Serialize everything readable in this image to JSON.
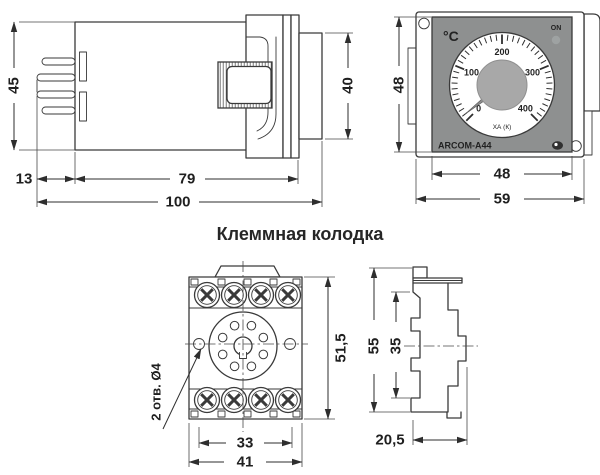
{
  "title": "Клеммная колодка",
  "views": {
    "side": {
      "dims": {
        "height": "45",
        "bezel_height": "40",
        "pin_length": "13",
        "body_length": "79",
        "total_length": "100"
      }
    },
    "front": {
      "dims": {
        "panel_height": "48",
        "panel_width": "48",
        "plate_width": "59"
      },
      "panel": {
        "unit": "°C",
        "on_label": "ON",
        "model": "ARCOM-A44",
        "thermocouple": "ХА (К)"
      },
      "gauge": {
        "type": "gauge",
        "min": 0,
        "max": 400,
        "major_ticks": [
          0,
          100,
          200,
          300,
          400
        ],
        "minor_step": 10,
        "start_angle": -135,
        "end_angle": 135,
        "pointer_value": 10,
        "unit": "°C"
      }
    },
    "terminal_front": {
      "dims": {
        "height": "51,5",
        "hole_note": "2 отв. Ø4",
        "hole_spacing": "33",
        "width": "41"
      }
    },
    "terminal_side": {
      "dims": {
        "height": "55",
        "inner_height": "35",
        "depth": "20,5"
      }
    }
  },
  "colors": {
    "line": "#3a3a3a",
    "panel_gray": "#8e9090",
    "knob_gray": "#a8a8a8",
    "led_gray": "#9ea2a2",
    "dial_white": "#ffffff",
    "needle_gray": "#8b8b8b"
  }
}
